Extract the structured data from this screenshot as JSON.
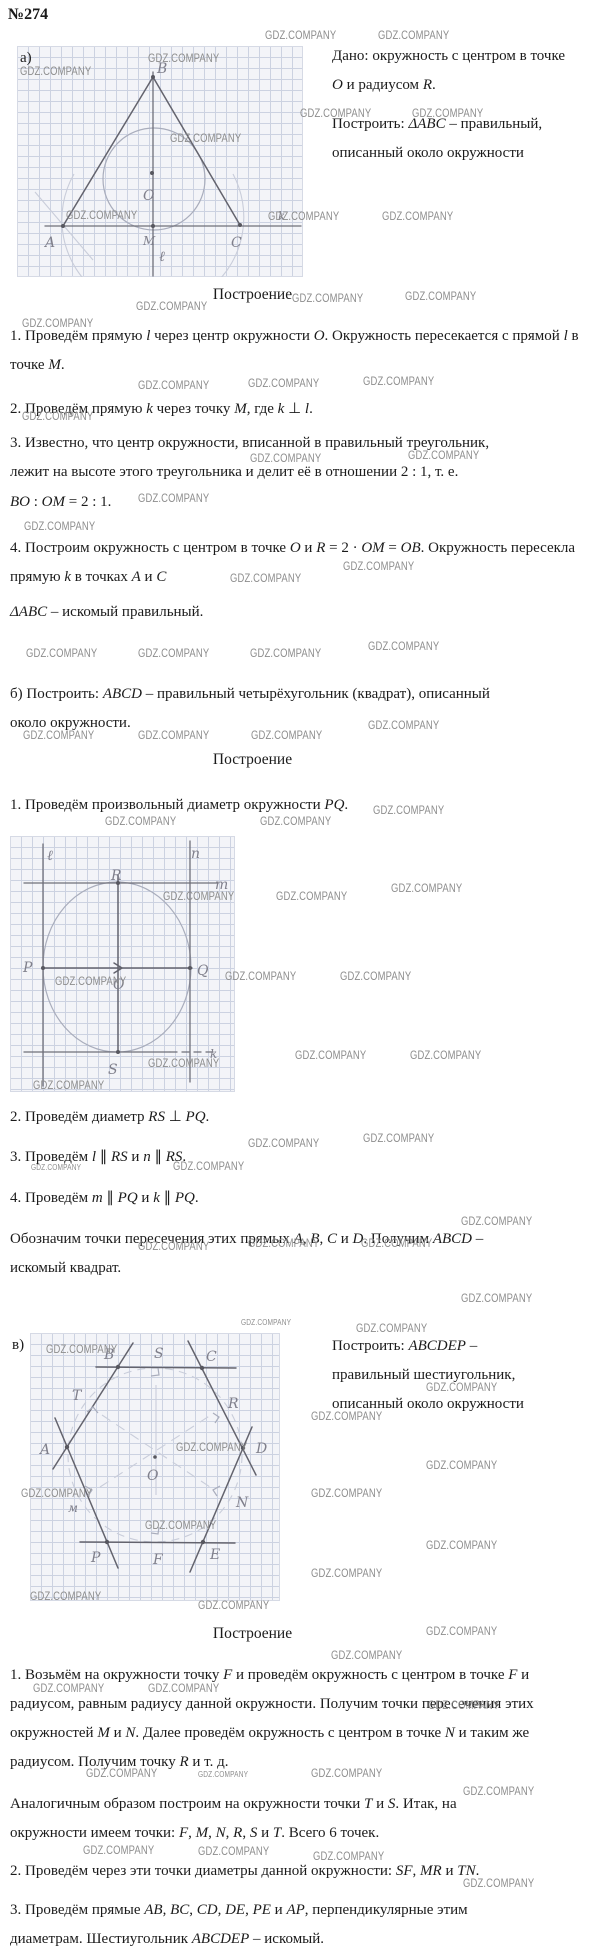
{
  "title": "№274",
  "colors": {
    "text": "#1b1b1b",
    "pencil": "#63636d",
    "pencil-light": "#a9adbc",
    "faint": "#c9cdda",
    "grid": "#ccd2e1",
    "paper": "#f3f4f8",
    "wm": "#8d8d8d",
    "hw": "#7f7f8b"
  },
  "watermarks": {
    "text": "GDZ.COMPANY",
    "positions": [
      [
        265,
        30
      ],
      [
        378,
        30
      ],
      [
        148,
        53
      ],
      [
        20,
        66
      ],
      [
        170,
        133
      ],
      [
        300,
        108
      ],
      [
        412,
        108
      ],
      [
        66,
        210
      ],
      [
        268,
        211
      ],
      [
        382,
        211
      ],
      [
        292,
        293
      ],
      [
        405,
        291
      ],
      [
        136,
        301
      ],
      [
        22,
        318
      ],
      [
        248,
        378
      ],
      [
        363,
        376
      ],
      [
        138,
        380
      ],
      [
        22,
        411
      ],
      [
        250,
        453
      ],
      [
        408,
        450
      ],
      [
        138,
        493
      ],
      [
        24,
        521
      ],
      [
        343,
        561
      ],
      [
        230,
        573
      ],
      [
        26,
        648
      ],
      [
        138,
        648
      ],
      [
        250,
        648
      ],
      [
        368,
        641
      ],
      [
        368,
        720
      ],
      [
        23,
        730
      ],
      [
        138,
        730
      ],
      [
        251,
        730
      ],
      [
        373,
        805
      ],
      [
        105,
        816
      ],
      [
        260,
        816
      ],
      [
        163,
        891
      ],
      [
        276,
        891
      ],
      [
        391,
        883
      ],
      [
        55,
        976
      ],
      [
        225,
        971
      ],
      [
        340,
        971
      ],
      [
        148,
        1058
      ],
      [
        295,
        1050
      ],
      [
        410,
        1050
      ],
      [
        33,
        1080
      ],
      [
        248,
        1138
      ],
      [
        363,
        1133
      ],
      [
        31,
        1163,
        "s"
      ],
      [
        173,
        1161
      ],
      [
        461,
        1216
      ],
      [
        138,
        1241
      ],
      [
        248,
        1238
      ],
      [
        361,
        1238
      ],
      [
        461,
        1293
      ],
      [
        241,
        1318,
        "s"
      ],
      [
        356,
        1323
      ],
      [
        46,
        1344
      ],
      [
        176,
        1442
      ],
      [
        21,
        1488
      ],
      [
        145,
        1520
      ],
      [
        30,
        1591
      ],
      [
        198,
        1600
      ],
      [
        426,
        1382
      ],
      [
        311,
        1411
      ],
      [
        426,
        1460
      ],
      [
        311,
        1488
      ],
      [
        426,
        1540
      ],
      [
        311,
        1568
      ],
      [
        426,
        1626
      ],
      [
        331,
        1650
      ],
      [
        33,
        1683
      ],
      [
        148,
        1683
      ],
      [
        428,
        1700
      ],
      [
        86,
        1768
      ],
      [
        198,
        1770,
        "s"
      ],
      [
        311,
        1768
      ],
      [
        463,
        1786
      ],
      [
        83,
        1845
      ],
      [
        198,
        1846
      ],
      [
        313,
        1851
      ],
      [
        463,
        1878
      ]
    ]
  },
  "sections": {
    "a": {
      "label": "а)",
      "given": "Дано: окружность с центром в точке O и радиусом R.",
      "build": "Построить: ΔABC – правильный, описанный около окружности",
      "heading": "Построение",
      "step1": "1. Проведём прямую l через центр окружности O. Окружность пересекается с прямой l в точке M.",
      "step2": "2. Проведём прямую k через точку M, где k ⊥ l.",
      "step3": "3. Известно, что центр окружности, вписанной в правильный треугольник, лежит на высоте этого треугольника и делит её в отношении 2 : 1, т. е.",
      "formula": "BO : OM = 2 : 1.",
      "step4": "4. Построим окружность с центром в точке O и R = 2 · OM = OB. Окружность пересекла прямую k в точках A и C",
      "result": "ΔABC – искомый правильный."
    },
    "b": {
      "intro": "б) Построить: ABCD – правильный четырёхугольник (квадрат), описанный около окружности.",
      "heading": "Построение",
      "step1": "1. Проведём произвольный диаметр окружности PQ.",
      "step2": "2. Проведём диаметр RS ⊥ PQ.",
      "step3": "3. Проведём  l ∥ RS  и  n ∥ RS.",
      "step4": "4. Проведём  m ∥ PQ  и  k ∥ PQ.",
      "conclusion": "Обозначим точки пересечения этих прямых A, B, C и D. Получим ABCD – искомый квадрат."
    },
    "v": {
      "label": "в)",
      "build_lines": [
        "Построить: ABCDEP –",
        "правильный шестиугольник,",
        "описанный около окружности"
      ],
      "heading": "Построение",
      "step1": "1. Возьмём на окружности точку F и проведём окружность с центром в точке F и радиусом, равным радиусу данной окружности. Получим точки пересечения этих окружностей M и N. Далее проведём окружность с центром в точке N и таким же радиусом. Получим точку R и т. д.",
      "note": "Аналогичным образом построим на окружности точки T и S. Итак, на окружности имеем точки: F, M, N, R, S и T. Всего 6 точек.",
      "step2": "2. Проведём через эти точки диаметры данной окружности: SF, MR и TN.",
      "step3": "3. Проведём прямые AB, BC, CD, DE, PE и AP, перпендикулярные этим диаметрам. Шестиугольник ABCDEP – искомый."
    }
  },
  "figures": {
    "a": {
      "labels": {
        "B": "B",
        "O": "O",
        "M": "M",
        "A": "A",
        "C": "C",
        "k": "k",
        "l": "ℓ"
      }
    },
    "b": {
      "labels": {
        "l": "ℓ",
        "R": "R",
        "n": "n",
        "m": "m",
        "P": "P",
        "Q": "Q",
        "O": "O",
        "S": "S",
        "k": "k"
      }
    },
    "c": {
      "labels": {
        "B": "B",
        "S": "S",
        "C": "C",
        "T": "T",
        "R": "R",
        "A": "A",
        "D": "D",
        "O": "O",
        "M": "м",
        "N": "N",
        "P": "P",
        "F": "F",
        "E": "E"
      }
    }
  }
}
